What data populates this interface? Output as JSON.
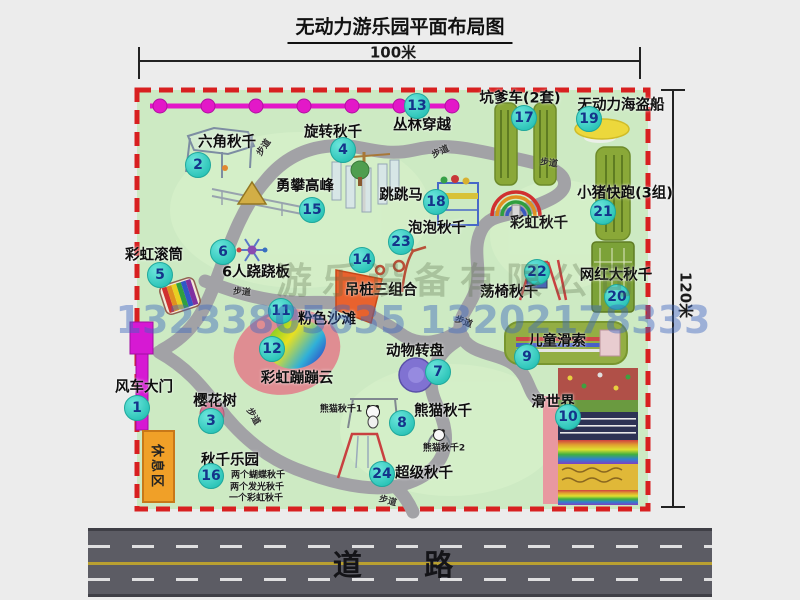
{
  "title": "无动力游乐园平面布局图",
  "dims": {
    "width": "100米",
    "height": "120米"
  },
  "road_label": "道  路",
  "rest_area_label": "休息区",
  "watermark_company": "游乐设备有限公司",
  "watermark_phone": "13233805635 13202178333",
  "colors": {
    "map_green": "#cdeac3",
    "border_red": "#d82020",
    "path_gray": "#a2a2a6",
    "badge_teal": "#2cc4b8",
    "badge_text": "#14348a",
    "magenta": "#d619d3",
    "pad_green": "#8aa838",
    "rest_orange": "#f0a028",
    "road_gray": "#5c5c64",
    "pirate_yellow": "#ecd83c",
    "turntable_purple": "#8072d2",
    "beach_pink": "#df8d92"
  },
  "markers": [
    {
      "num": 1,
      "label": "风车大门",
      "bx": 137,
      "by": 408,
      "lx": 144,
      "ly": 386
    },
    {
      "num": 2,
      "label": "六角秋千",
      "bx": 198,
      "by": 165,
      "lx": 227,
      "ly": 141
    },
    {
      "num": 3,
      "label": "樱花树",
      "bx": 211,
      "by": 421,
      "lx": 215,
      "ly": 400
    },
    {
      "num": 4,
      "label": "旋转秋千",
      "bx": 343,
      "by": 150,
      "lx": 333,
      "ly": 131
    },
    {
      "num": 5,
      "label": "彩虹滚筒",
      "bx": 160,
      "by": 275,
      "lx": 154,
      "ly": 254
    },
    {
      "num": 6,
      "label": "6人跷跷板",
      "bx": 223,
      "by": 252,
      "lx": 256,
      "ly": 271
    },
    {
      "num": 7,
      "label": "动物转盘",
      "bx": 438,
      "by": 372,
      "lx": 415,
      "ly": 350
    },
    {
      "num": 8,
      "label": "熊猫秋千",
      "bx": 402,
      "by": 423,
      "lx": 443,
      "ly": 410
    },
    {
      "num": 9,
      "label": "儿童滑索",
      "bx": 527,
      "by": 357,
      "lx": 557,
      "ly": 340
    },
    {
      "num": 10,
      "label": "滑世界",
      "bx": 568,
      "by": 417,
      "lx": 553,
      "ly": 401
    },
    {
      "num": 11,
      "label": "粉色沙滩",
      "bx": 281,
      "by": 311,
      "lx": 327,
      "ly": 318
    },
    {
      "num": 12,
      "label": "彩虹蹦蹦云",
      "bx": 272,
      "by": 349,
      "lx": 297,
      "ly": 377
    },
    {
      "num": 13,
      "label": "丛林穿越",
      "bx": 417,
      "by": 106,
      "lx": 422,
      "ly": 124
    },
    {
      "num": 14,
      "label": "吊桩三组合",
      "bx": 362,
      "by": 260,
      "lx": 381,
      "ly": 289
    },
    {
      "num": 15,
      "label": "勇攀高峰",
      "bx": 312,
      "by": 210,
      "lx": 305,
      "ly": 185
    },
    {
      "num": 16,
      "label": "秋千乐园",
      "bx": 211,
      "by": 476,
      "lx": 230,
      "ly": 459
    },
    {
      "num": 17,
      "label": "坑爹车(2套)",
      "bx": 524,
      "by": 118,
      "lx": 520,
      "ly": 97
    },
    {
      "num": 18,
      "label": "跳跳马",
      "bx": 436,
      "by": 202,
      "lx": 401,
      "ly": 194
    },
    {
      "num": 19,
      "label": "无动力海盗船",
      "bx": 589,
      "by": 119,
      "lx": 621,
      "ly": 104
    },
    {
      "num": 20,
      "label": "网红大秋千",
      "bx": 617,
      "by": 297,
      "lx": 616,
      "ly": 274
    },
    {
      "num": 21,
      "label": "小猪快跑(3组)",
      "bx": 603,
      "by": 212,
      "lx": 625,
      "ly": 192
    },
    {
      "num": 22,
      "label": "荡椅秋千",
      "bx": 537,
      "by": 272,
      "lx": 509,
      "ly": 291
    },
    {
      "num": 23,
      "label": "泡泡秋千",
      "bx": 401,
      "by": 242,
      "lx": 437,
      "ly": 227
    },
    {
      "num": 24,
      "label": "超级秋千",
      "bx": 382,
      "by": 474,
      "lx": 424,
      "ly": 472
    }
  ],
  "extra_labels": [
    {
      "text": "彩虹秋千",
      "x": 539,
      "y": 222,
      "size": 14.5
    },
    {
      "text": "熊猫秋千1",
      "x": 341,
      "y": 408,
      "size": 9
    },
    {
      "text": "熊猫秋千2",
      "x": 444,
      "y": 447,
      "size": 9
    },
    {
      "text": "两个蝴蝶秋千",
      "x": 258,
      "y": 474,
      "size": 9
    },
    {
      "text": "两个发光秋千",
      "x": 257,
      "y": 486,
      "size": 9
    },
    {
      "text": "一个彩虹秋千",
      "x": 256,
      "y": 497,
      "size": 9
    }
  ],
  "path_labels": [
    {
      "text": "步道",
      "x": 263,
      "y": 147,
      "rot": -55
    },
    {
      "text": "步道",
      "x": 440,
      "y": 151,
      "rot": -25
    },
    {
      "text": "步道",
      "x": 549,
      "y": 162,
      "rot": 8
    },
    {
      "text": "步道",
      "x": 242,
      "y": 291,
      "rot": 5
    },
    {
      "text": "步道",
      "x": 464,
      "y": 321,
      "rot": 20
    },
    {
      "text": "步道",
      "x": 254,
      "y": 416,
      "rot": 60
    },
    {
      "text": "步道",
      "x": 388,
      "y": 500,
      "rot": 15
    }
  ]
}
